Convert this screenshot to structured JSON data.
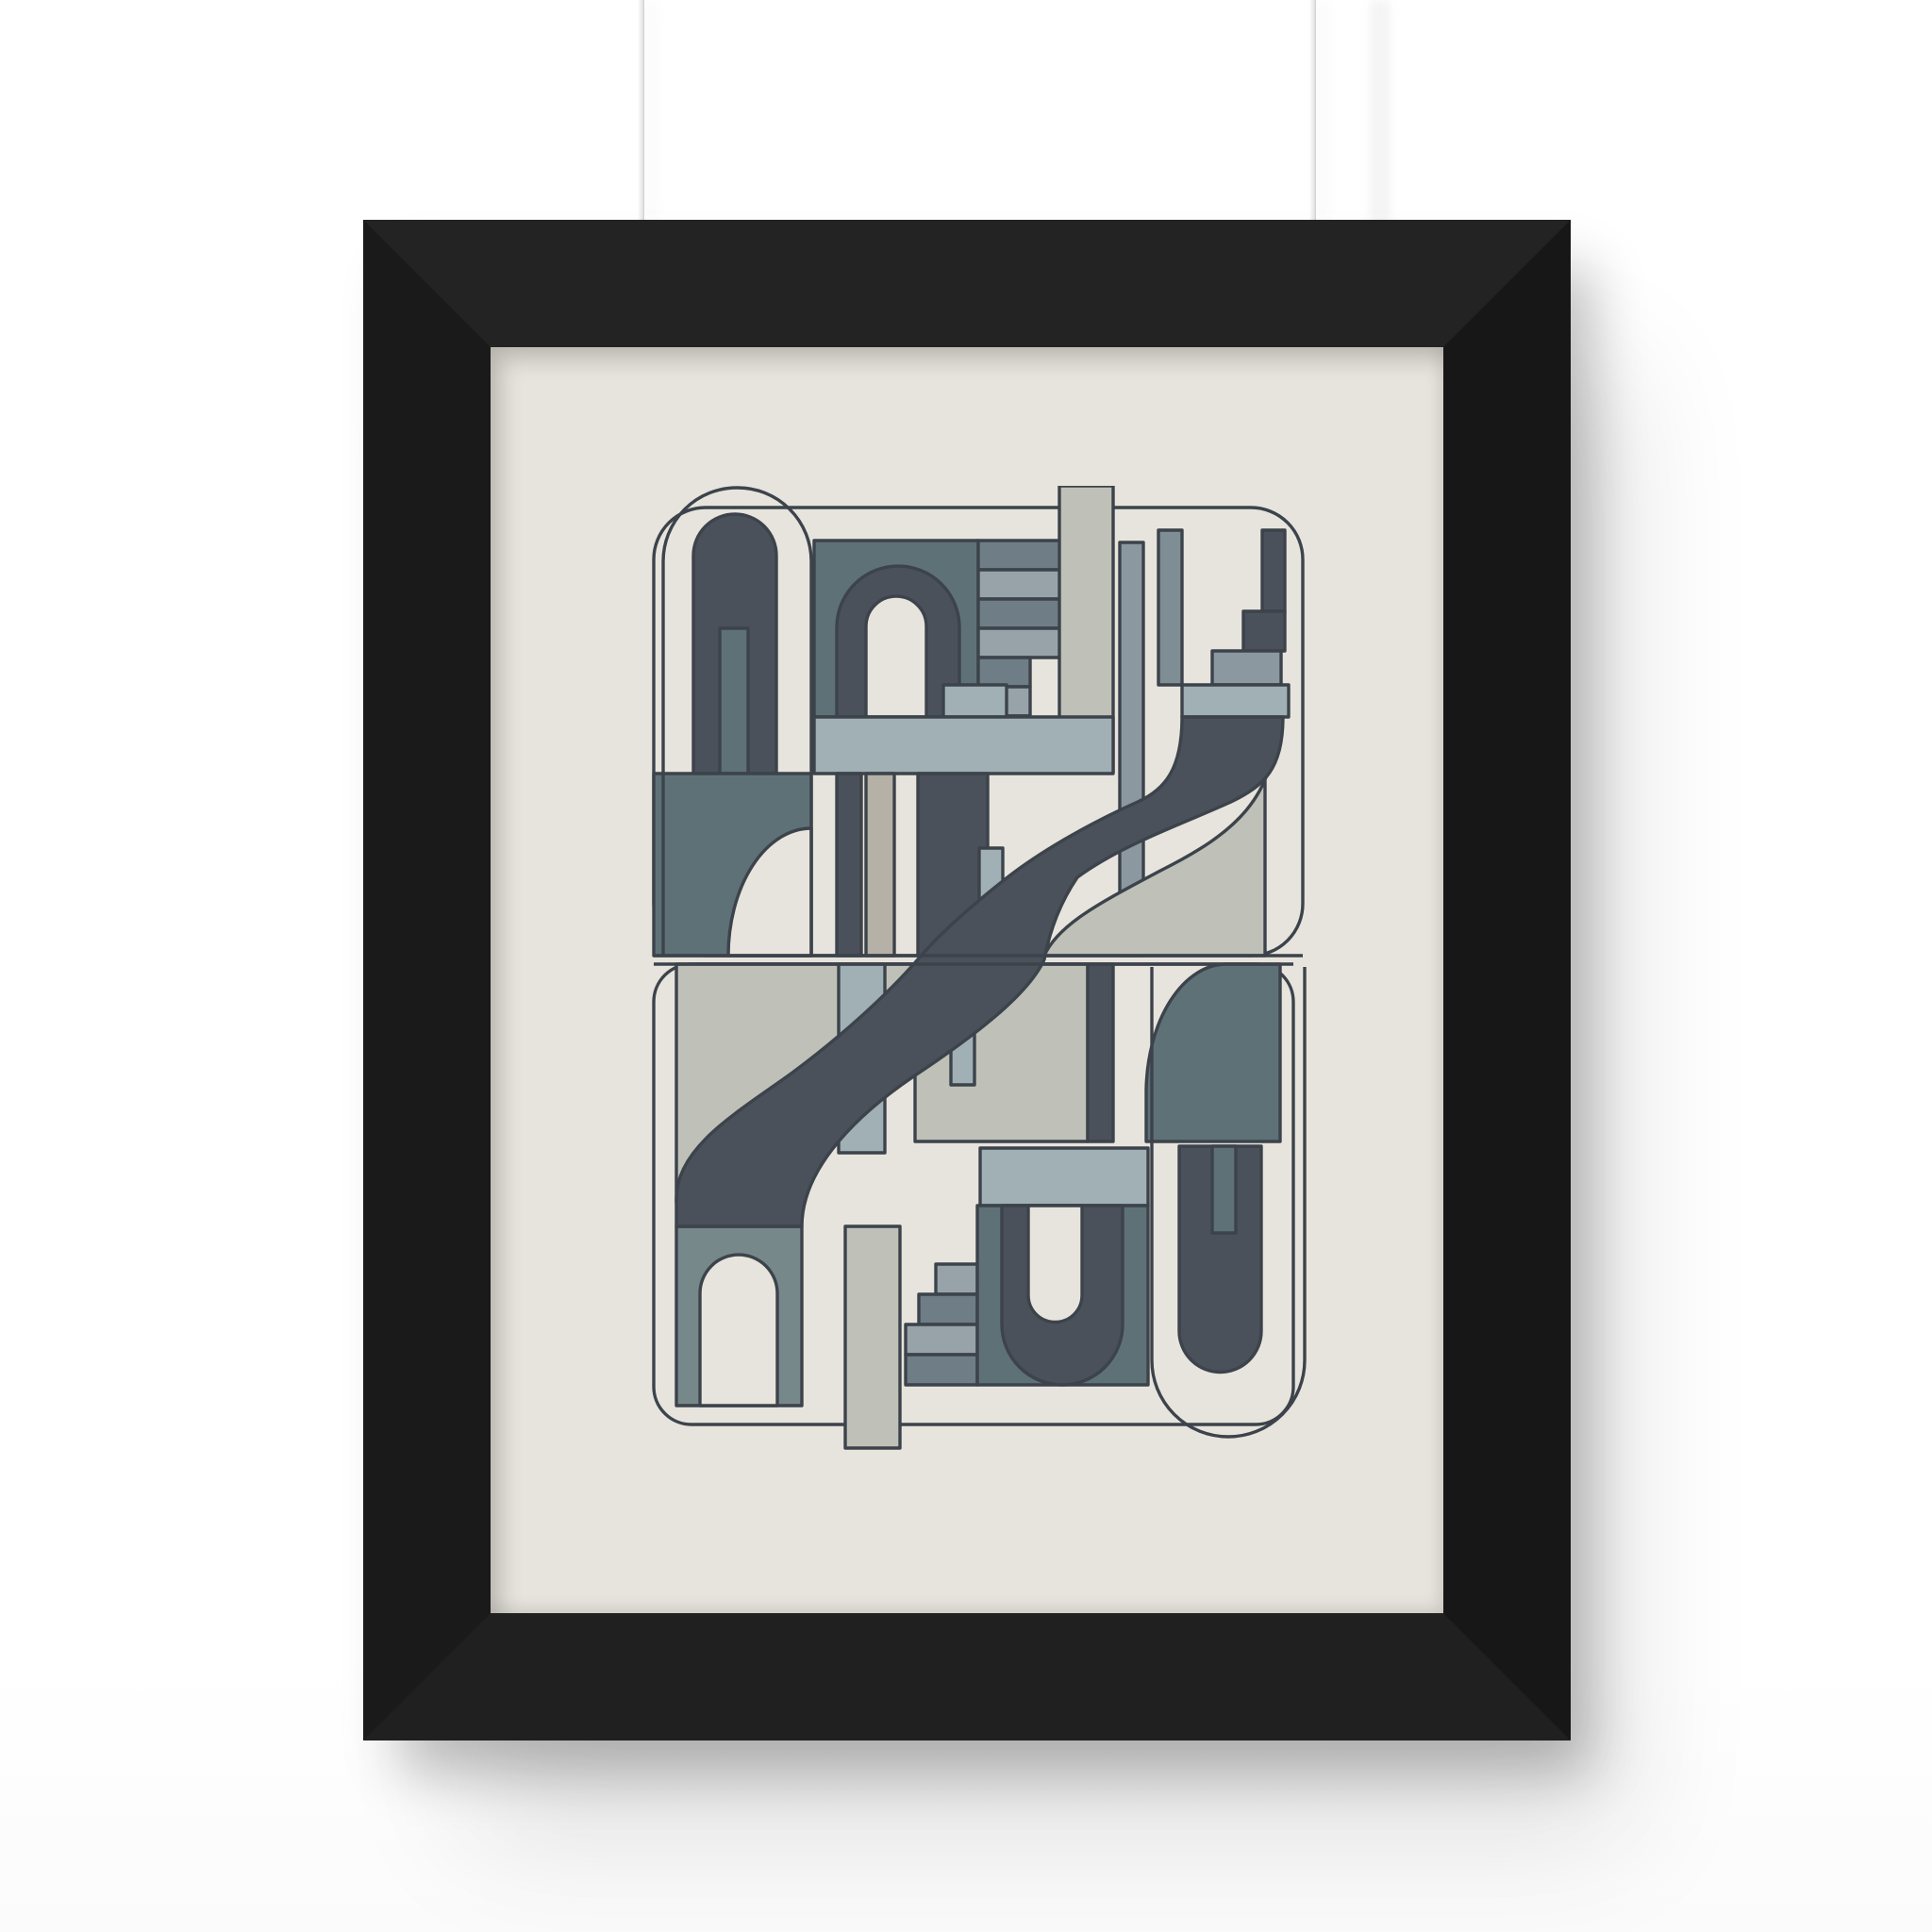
{
  "scene": {
    "description_label": "",
    "css_vars": {
      "wall": "#ffffff",
      "wall-low": "#fbfbfb",
      "string": "#e3e3e3",
      "string-edge": "#c9c9c9",
      "frame": "#1c1c1c",
      "frame-top": "#232323",
      "frame-left": "#1a1a1a",
      "frame-right": "#171717",
      "frame-bottom": "#202020",
      "mat": "#e7e4dd",
      "shadow-strong": "rgba(0,0,0,0.24)",
      "shadow-soft": "rgba(0,0,0,0.11)"
    }
  },
  "artwork": {
    "palette": {
      "cream": "#e7e4dd",
      "outline": "#3c434b",
      "darkslate": "#4b515a",
      "teal": "#5e7177",
      "tealLight": "#76888a",
      "slate": "#6f7d86",
      "slateLight": "#97a3a8",
      "blueGray": "#a0b0b5",
      "greenGray": "#bfc1b8",
      "warmGray": "#b5b1a6",
      "colGray": "#8b98a0",
      "colGray2": "#7f8d95",
      "none": "none"
    }
  }
}
